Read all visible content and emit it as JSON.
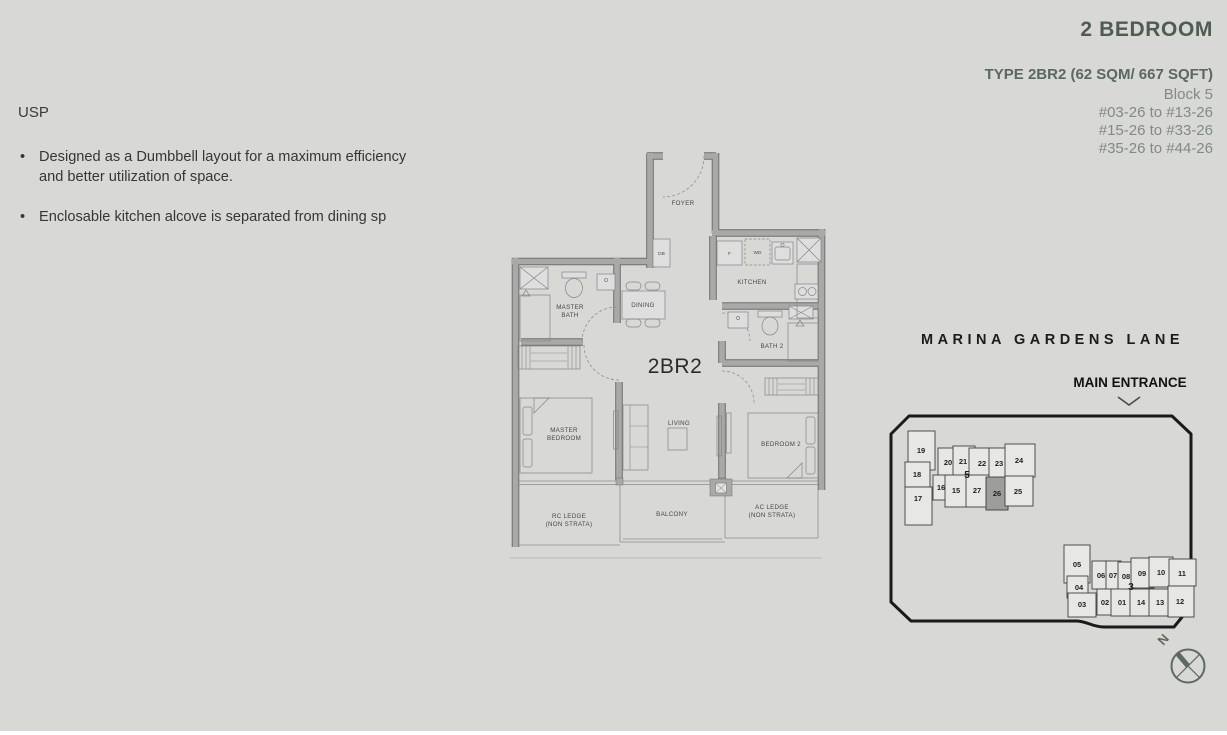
{
  "header": {
    "title": "2 BEDROOM",
    "type_line": "TYPE 2BR2 (62 SQM/ 667 SQFT)",
    "block": "Block 5",
    "stack_ranges": [
      "#03-26 to #13-26",
      "#15-26 to #33-26",
      "#35-26 to #44-26"
    ]
  },
  "usp": {
    "heading": "USP",
    "bullets": [
      "Designed as a Dumbbell layout for a maximum efficiency and better utilization of space.",
      "Enclosable kitchen alcove is separated from dining sp"
    ]
  },
  "floor_plan": {
    "unit_label": "2BR2",
    "rooms": {
      "foyer": "FOYER",
      "kitchen": "KITCHEN",
      "dining": "DINING",
      "master_bath": "MASTER\nBATH",
      "bath2": "BATH 2",
      "master_bedroom": "MASTER\nBEDROOM",
      "living": "LIVING",
      "bedroom2": "BEDROOM 2",
      "balcony": "BALCONY",
      "rc_ledge": "RC LEDGE\n(NON STRATA)",
      "ac_ledge": "AC LEDGE\n(NON STRATA)"
    },
    "fixtures": {
      "db": "DB",
      "fridge": "F",
      "washer_dryer": "WD"
    }
  },
  "site_plan": {
    "street_name": "MARINA GARDENS LANE",
    "entrance_label": "MAIN ENTRANCE",
    "compass_north": "N",
    "highlighted_stack": "26",
    "block5": {
      "label": "5",
      "stacks": {
        "15": "15",
        "16": "16",
        "17": "17",
        "18": "18",
        "19": "19",
        "20": "20",
        "21": "21",
        "22": "22",
        "23": "23",
        "24": "24",
        "25": "25",
        "26": "26",
        "27": "27"
      }
    },
    "block3": {
      "label": "3",
      "stacks": {
        "01": "01",
        "02": "02",
        "03": "03",
        "04": "04",
        "05": "05",
        "06": "06",
        "07": "07",
        "08": "08",
        "09": "09",
        "10": "10",
        "11": "11",
        "12": "12",
        "13": "13",
        "14": "14"
      }
    }
  },
  "colors": {
    "background": "#d8d8d6",
    "title_green": "#4e5c52",
    "subtitle_gray_green": "#7f8b83",
    "wall_gray": "#a9a9a7",
    "site_outline": "#1a1a1a",
    "highlight_unit_fill": "#9d9d9b"
  }
}
